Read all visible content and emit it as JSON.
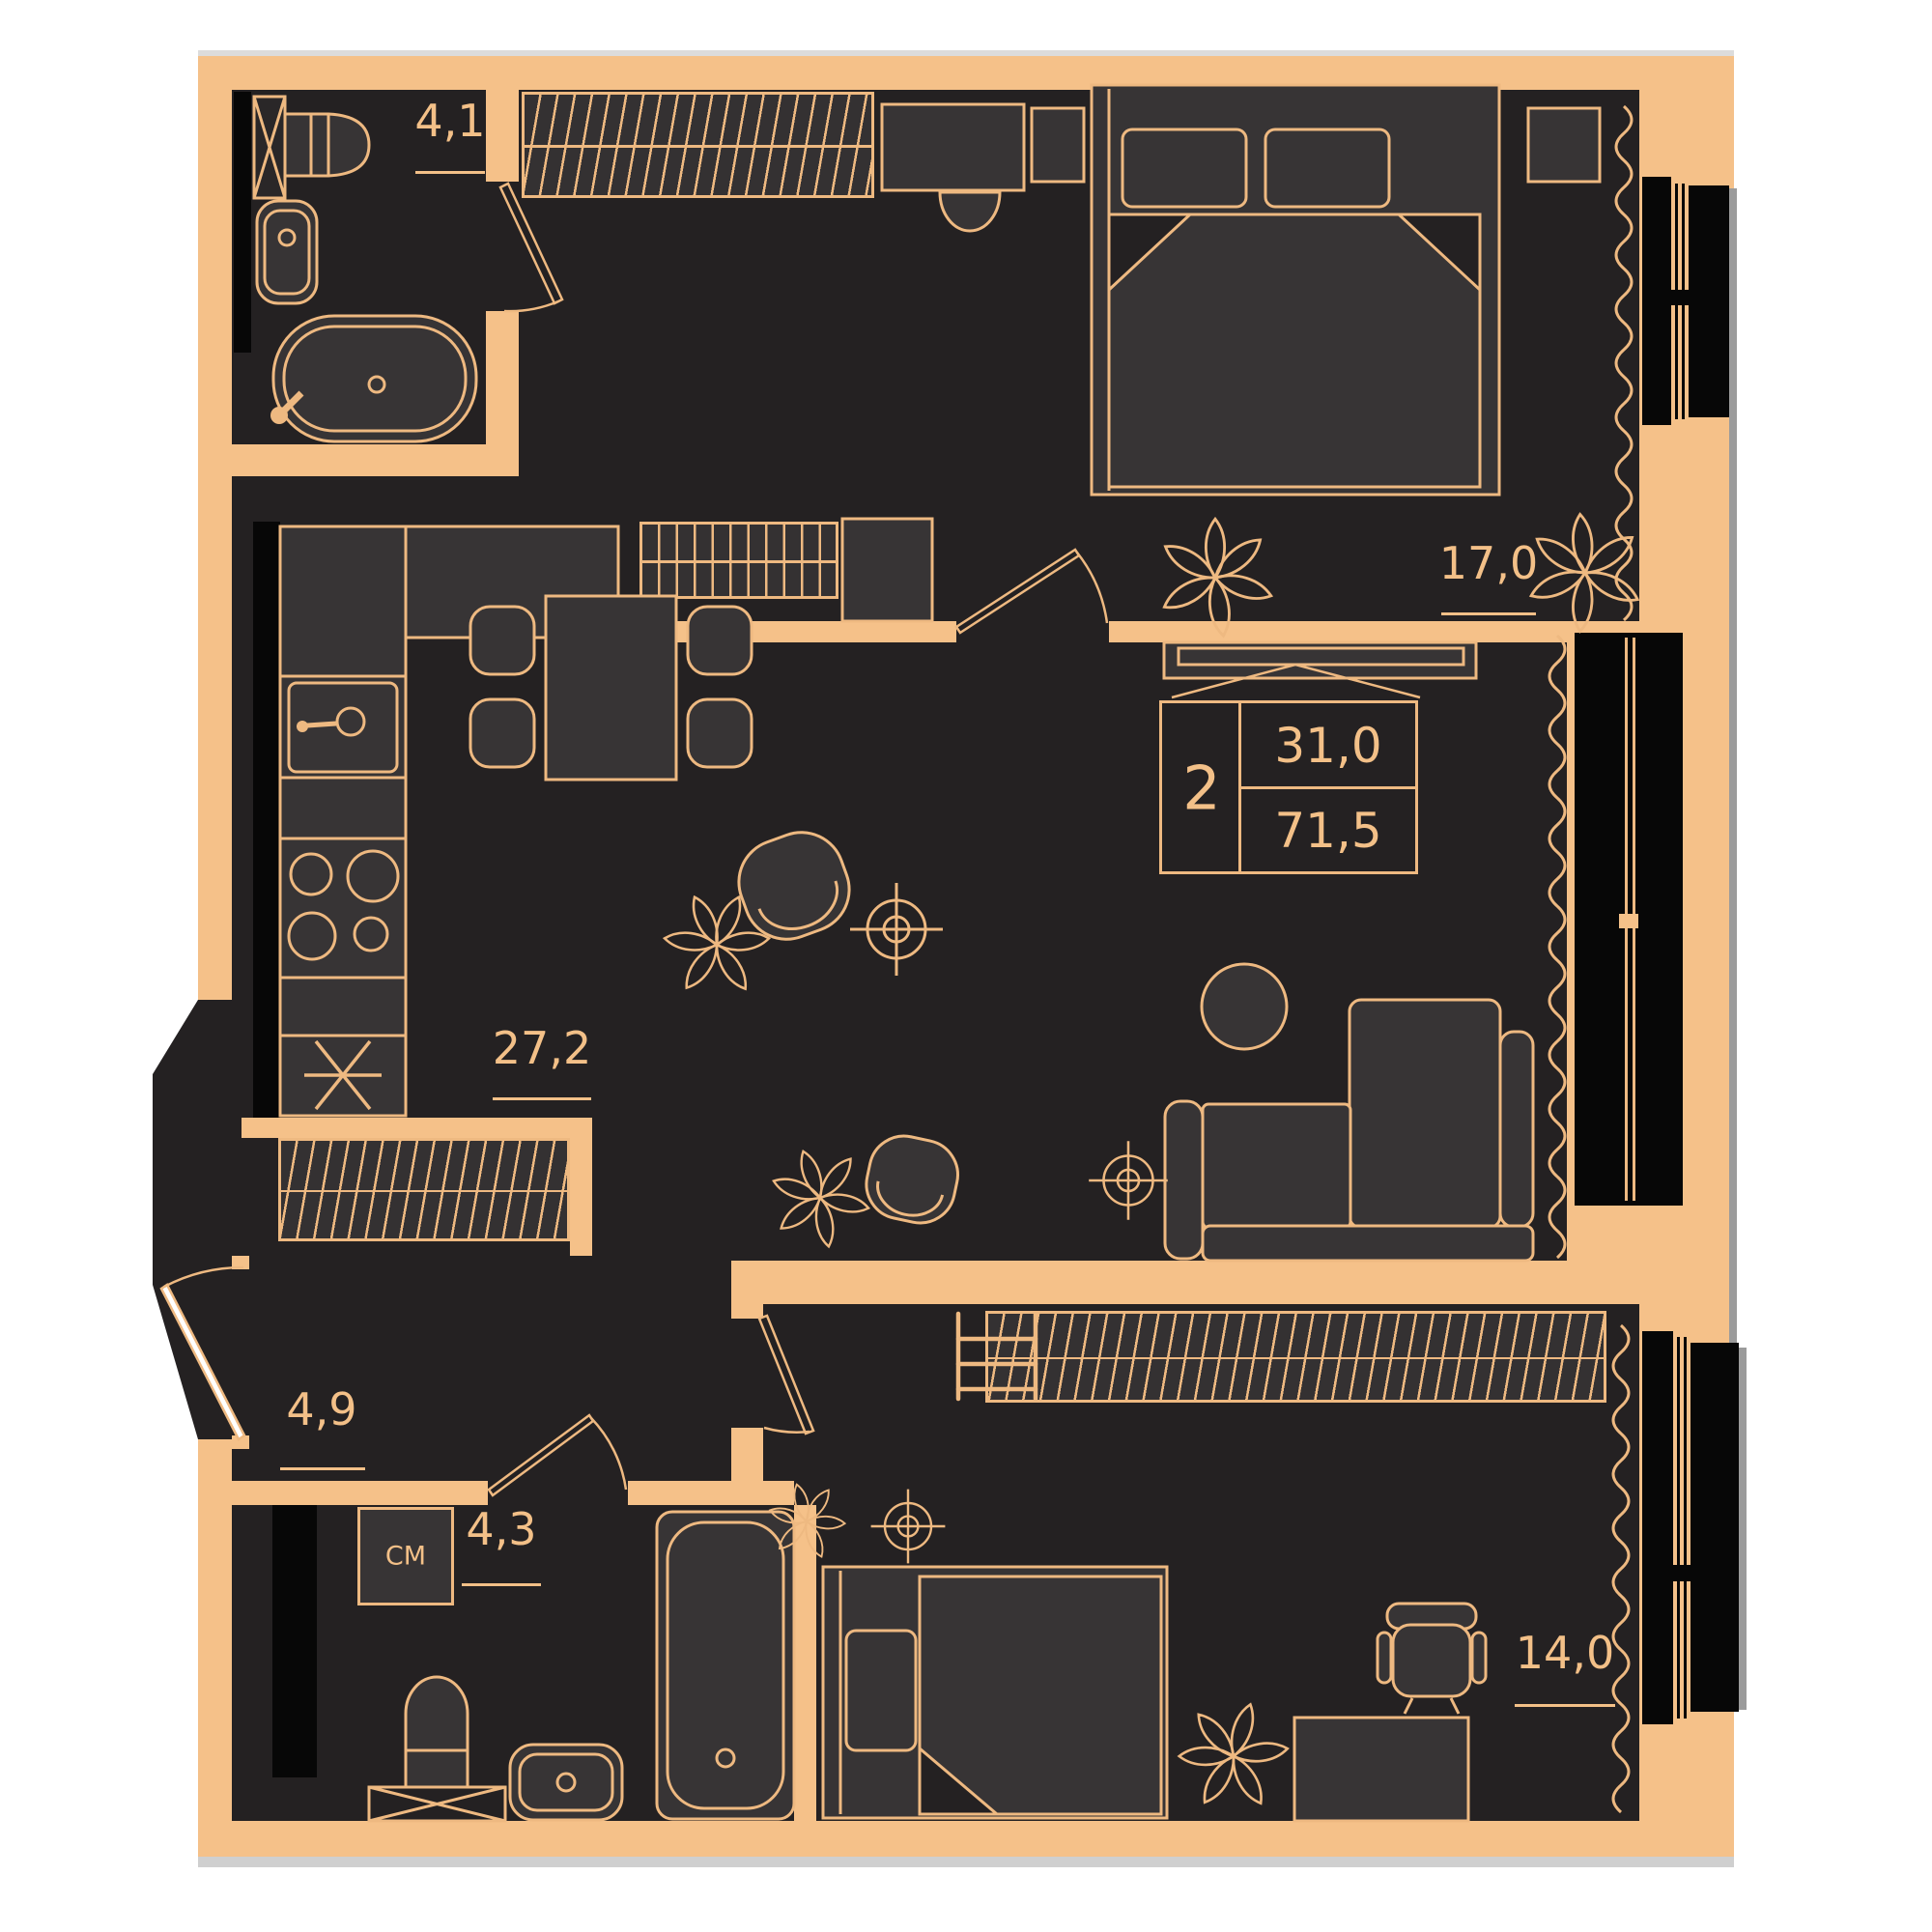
{
  "info_box": {
    "rooms_count": "2",
    "living_area": "31,0",
    "total_area": "71,5"
  },
  "rooms": [
    {
      "name": "bathroom-1",
      "area": "4,1"
    },
    {
      "name": "bedroom-1",
      "area": "17,0"
    },
    {
      "name": "kitchen-living-room",
      "area": "27,2"
    },
    {
      "name": "hallway",
      "area": "4,9"
    },
    {
      "name": "bathroom-2",
      "area": "4,3"
    },
    {
      "name": "bedroom-2",
      "area": "14,0"
    }
  ],
  "appliance_labels": {
    "washing_machine": "СМ"
  },
  "colors": {
    "wall": "#f5c189",
    "line": "#eeb981",
    "interior": "#242122",
    "furniture": "#373435",
    "window_frame": "#070707",
    "shadow": "#cfcfcf",
    "background": "#ffffff"
  }
}
